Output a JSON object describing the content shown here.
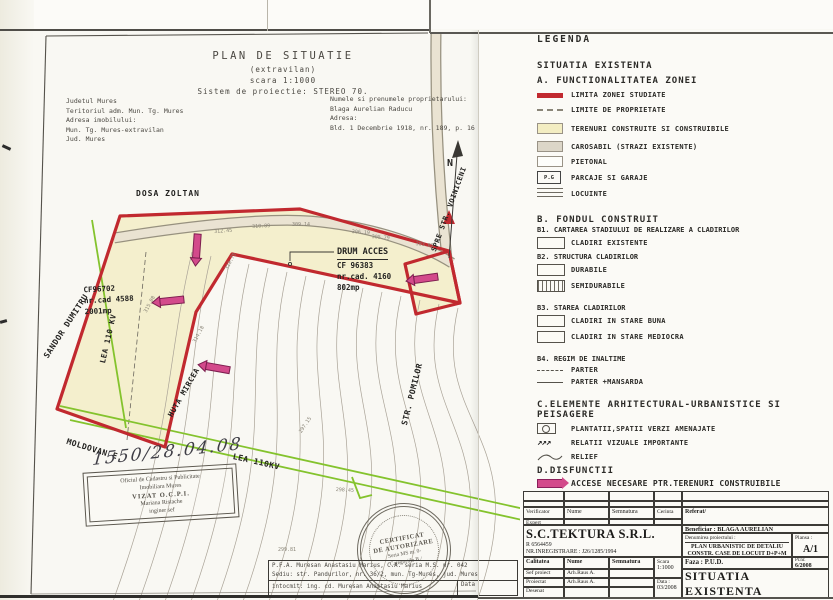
{
  "plan": {
    "title": "PLAN DE SITUATIE",
    "subtitle": "(extravilan)",
    "scale_note": "scara 1:1000",
    "projection_note": "Sistem de proiectie: STEREO 70.",
    "location_lines": [
      "Judetul Mures",
      "Teritoriul adm. Mun. Tg. Mures",
      "Adresa imobilului:",
      "Mun. Tg. Mures-extravilan",
      "Jud. Mures"
    ],
    "owner_lines": [
      "Numele si prenumele proprietarului:",
      "Blaga Aurelian Raducu",
      "Adresa:",
      "Bld. 1 Decembrie 1918, nr. 189, p. 16"
    ],
    "labels": {
      "dosa_zoltan": "DOSA ZOLTAN",
      "sandor_dumitru": "SANDOR DUMITRU",
      "lea_110kv_left": "LEA 110 KV",
      "moldovan": "MOLDOVAN E.",
      "huta_mircea": "HUTA MIRCEA",
      "lea_110kv_bottom": "LEA 110KV",
      "str_pomilor": "STR. POMILOR",
      "spre_voiniceni": "SPRE STR. VOINICENI",
      "north": "N",
      "drum_acces": "DRUM ACCES",
      "drum_cf": "CF 96383",
      "drum_cad": "nr.cad. 4160",
      "drum_area": "802mp",
      "parcel_cf": "CF96702",
      "parcel_cad": "nr.cad 4588",
      "parcel_area": "2001mp"
    },
    "elevations": [
      "312.45",
      "310.89",
      "309.14",
      "306.19",
      "305.79",
      "303.85",
      "315.08",
      "314.18",
      "313.75",
      "299.81",
      "298.45",
      "297.15"
    ],
    "stamps": {
      "registry_number": "1550/28.04.08",
      "ocpi_lines": [
        "Oficiul de Cadastru si Publicitate",
        "Imobiliara Mures",
        "VIZAT  O.C.P.I.",
        "Mariana Ristache",
        "inginer sef"
      ],
      "certificate_lines": [
        "CERTIFICAT",
        "DE AUTORIZARE",
        "Seria MS nr. 0-",
        "Categoriile B /"
      ],
      "author_lines": [
        "P.F.A. Muresan Anastasiu Marius, C.A. seria M.S. nr. 042",
        "Sediu: str. Pandurilor, nr. 36/2, mun. Tg-Mures, jud. Mures",
        "intocmit: ing. cd. Muresan Anastasiu Marius"
      ],
      "data_label": "Data"
    }
  },
  "legend": {
    "title": "LEGENDA",
    "existing_heading": "SITUATIA EXISTENTA",
    "section_a": {
      "title": "A. FUNCTIONALITATEA ZONEI",
      "items": [
        {
          "icon": "study-limit-line",
          "label": "LIMITA ZONEI STUDIATE"
        },
        {
          "icon": "property-limit-line",
          "label": "LIMITE DE PROPRIETATE"
        },
        {
          "icon": "buildable-land-area",
          "label": "TERENURI CONSTRUITE SI CONSTRUIBILE"
        },
        {
          "icon": "roadway-area",
          "label": "CAROSABIL (STRAZI EXISTENTE)"
        },
        {
          "icon": "pedestrian-area",
          "label": "PIETONAL"
        },
        {
          "icon": "parking-garage-box",
          "box_text": "P.G",
          "label": "PARCAJE SI GARAJE"
        },
        {
          "icon": "housing-lines",
          "label": "LOCUINTE"
        }
      ]
    },
    "section_b": {
      "title": "B. FONDUL CONSTRUIT",
      "sub_b1": {
        "title": "B1. CARTAREA STADIULUI DE REALIZARE A CLADIRILOR",
        "items": [
          {
            "icon": "existing-building-box",
            "label": "CLADIRI EXISTENTE"
          }
        ]
      },
      "sub_b2": {
        "title": "B2. STRUCTURA CLADIRILOR",
        "items": [
          {
            "icon": "durable-box",
            "label": "DURABILE"
          },
          {
            "icon": "semi-durable-hatch-box",
            "label": "SEMIDURABILE"
          }
        ]
      },
      "sub_b3": {
        "title": "B3. STAREA CLADIRILOR",
        "items": [
          {
            "icon": "good-state-box",
            "label": "CLADIRI IN STARE BUNA"
          },
          {
            "icon": "medium-state-box",
            "label": "CLADIRI IN STARE MEDIOCRA"
          }
        ]
      },
      "sub_b4": {
        "title": "B4. REGIM DE INALTIME",
        "items": [
          {
            "icon": "ground-floor-dash",
            "label": "PARTER"
          },
          {
            "icon": "mansard-line",
            "label": "PARTER +MANSARDA"
          }
        ]
      }
    },
    "section_c": {
      "title": "C.ELEMENTE ARHITECTURAL-URBANISTICE SI PEISAGERE",
      "items": [
        {
          "icon": "green-space-box",
          "label": "PLANTATII,SPATII VERZI AMENAJATE"
        },
        {
          "icon": "visual-relation-arrows",
          "label": "RELATII VIZUALE IMPORTANTE"
        },
        {
          "icon": "relief-curve",
          "label": "RELIEF"
        }
      ]
    },
    "section_d": {
      "title": "D.DISFUNCTII",
      "items": [
        {
          "icon": "required-access-arrow",
          "label": "ACCESE NECESARE PTR.TERENURI CONSTRUIBILE"
        }
      ]
    }
  },
  "title_block": {
    "verificator_label": "Verificator",
    "expert_label": "Expert",
    "nume_label": "Nume",
    "semnatura_label": "Semnatura",
    "cerinta_label": "Cerinta",
    "referat_label": "Referat/",
    "company_name": "S.C.TEKTURA S.R.L.",
    "company_reg": "R 6564459",
    "company_reg2": "NR.INREGISTRARE : J26/1285/1994",
    "beneficiar": "Beneficiar : BLAGA AURELIAN",
    "denumire_label": "Denumirea proiectului :",
    "project_lines": [
      "PLAN URBANISTIC DE DETALIU",
      "CONSTR. CASE DE LOCUIT D+P+M",
      "STR. POMILOR FN. TG. MURES"
    ],
    "plansa_label": "Plansa :",
    "plansa_value": "A/1",
    "calitatea_label": "Calitatea",
    "nume2_label": "Nume",
    "semnatura2_label": "Semnatura",
    "scara_label": "Scara",
    "scara_value": "1:1000",
    "faza": "Faza : P.U.D.",
    "prnr_label": "Pr.nr.",
    "prnr_value": "6/2008",
    "staff": [
      {
        "role": "Sef proiect",
        "name": "Arh.Raus A."
      },
      {
        "role": "Proiectat",
        "name": "Arh.Raus A."
      },
      {
        "role": "Desenat",
        "name": ""
      }
    ],
    "data_label": "Data :",
    "data_value": "03/2008",
    "sheet_title": "SITUATIA EXISTENTA"
  },
  "colors": {
    "boundary_red": "#c1292f",
    "access_magenta": "#d34a8b",
    "power_line_green": "#84c32d",
    "parcel_yellow": "#f4efcd"
  }
}
